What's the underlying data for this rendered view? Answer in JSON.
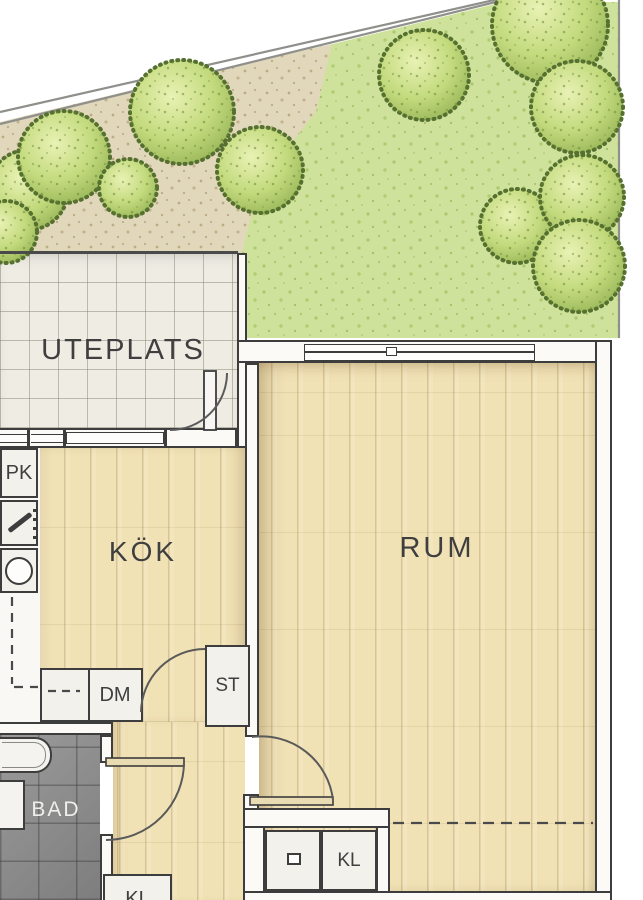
{
  "plan_title": "Apartment floor plan",
  "rooms": {
    "uteplats": {
      "label": "UTEPLATS"
    },
    "kok": {
      "label": "KÖK"
    },
    "rum": {
      "label": "RUM"
    },
    "bad": {
      "label": "BAD"
    }
  },
  "fixtures": {
    "pk": {
      "label": "PK"
    },
    "dm": {
      "label": "DM"
    },
    "st": {
      "label": "ST"
    },
    "kl": {
      "label": "KL"
    },
    "kl_bottom": {
      "label": "KL"
    }
  },
  "colors": {
    "wall_line": "#3d3d3d",
    "wood_floor": "#f1e2b6",
    "patio_tile": "#eeece3",
    "bathroom_tile": "#8f8f8f",
    "grass": "#cfe29b",
    "gravel": "#e1d7ba",
    "tree_edge": "#55702f",
    "tree_light": "#e8f2b4",
    "tree_mid": "#c3da7d",
    "tree_dark": "#93b253"
  }
}
